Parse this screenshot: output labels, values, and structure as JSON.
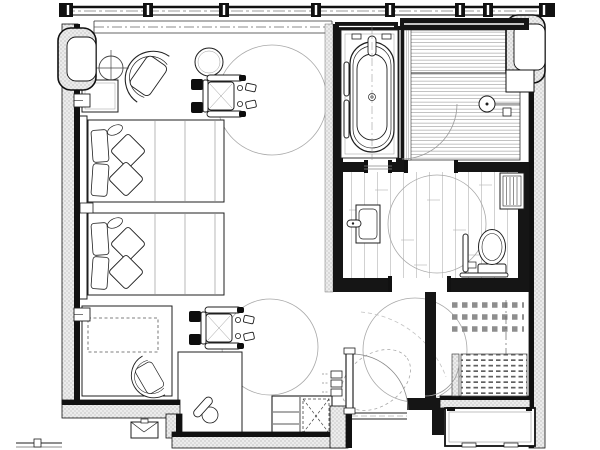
{
  "document": {
    "title": "Accessible hotel guest room floor plan",
    "type": "architectural-floor-plan",
    "notation": "black and white CAD plan-view linework, no text labels visible"
  },
  "colors": {
    "background": "#ffffff",
    "linework": "#1f1f1f",
    "wall_solid": "#151515",
    "wall_hatch": "#ececec",
    "hatch_dot": "#8a8a8a",
    "light_line": "#a8a8a8",
    "floor_line": "#b3b3b3"
  },
  "rooms": [
    {
      "name": "bedroom",
      "label": "Guest room sleeping and living area",
      "fixtures": [
        "twin bed 1 with pillows",
        "twin bed 2 with pillows",
        "headboards",
        "wall nightstand",
        "lounge chair",
        "round side table",
        "square side table",
        "floor lamp",
        "console cabinet with dashed luggage rack",
        "desk",
        "desk chair",
        "telephone on desk",
        "minibar cabinet with dashed X unit",
        "floor outlet box",
        "curtain track at window wall"
      ]
    },
    {
      "name": "bathtub-alcove",
      "label": "Bathtub alcove",
      "fixtures": [
        "freestanding oval bathtub",
        "deck faucet and spout",
        "two wall grab bars",
        "tiled surround",
        "centerline"
      ]
    },
    {
      "name": "shower",
      "label": "Roll-in shower",
      "fixtures": [
        "slatted shower floor",
        "linear drain strip",
        "hand shower on bar",
        "wall seat niche",
        "glass door swing arc"
      ]
    },
    {
      "name": "bathroom",
      "label": "Bathroom",
      "fixtures": [
        "vanity counter with basin and faucet",
        "toilet with tank",
        "vertical grab bar",
        "horizontal grab bar",
        "towel shelf rack",
        "plank tile floor",
        "turning circle"
      ]
    },
    {
      "name": "entry",
      "label": "Entry hall",
      "fixtures": [
        "entry swing door with arc",
        "threshold",
        "light switch stack",
        "turning circle",
        "maneuvering ellipse"
      ]
    },
    {
      "name": "closet",
      "label": "Closet / wardrobe",
      "fixtures": [
        "dashed overhead shelving rows",
        "dash-dot centerline",
        "floor grid mat",
        "door swing arc"
      ]
    },
    {
      "name": "vestibule",
      "label": "Exterior corridor niche at entry",
      "fixtures": [
        "open alcove outline"
      ]
    }
  ],
  "accessibility": {
    "wheelchair_symbols": 2,
    "turning_circles": 4,
    "description": "wheelchair plan symbols near window and near desk; turning-radius circles in bedroom (2), bathroom (1) and entry (1)"
  },
  "architecture": {
    "window_wall": "full-width mullioned window band across the top",
    "exterior_walls": "stipple-hatched poche with heavy inner face lines",
    "partitions": "solid black partition walls around bathroom core",
    "doors": [
      "entry door (open, with swing arc)",
      "shower door arc",
      "bathroom opening",
      "closet door arc"
    ]
  }
}
